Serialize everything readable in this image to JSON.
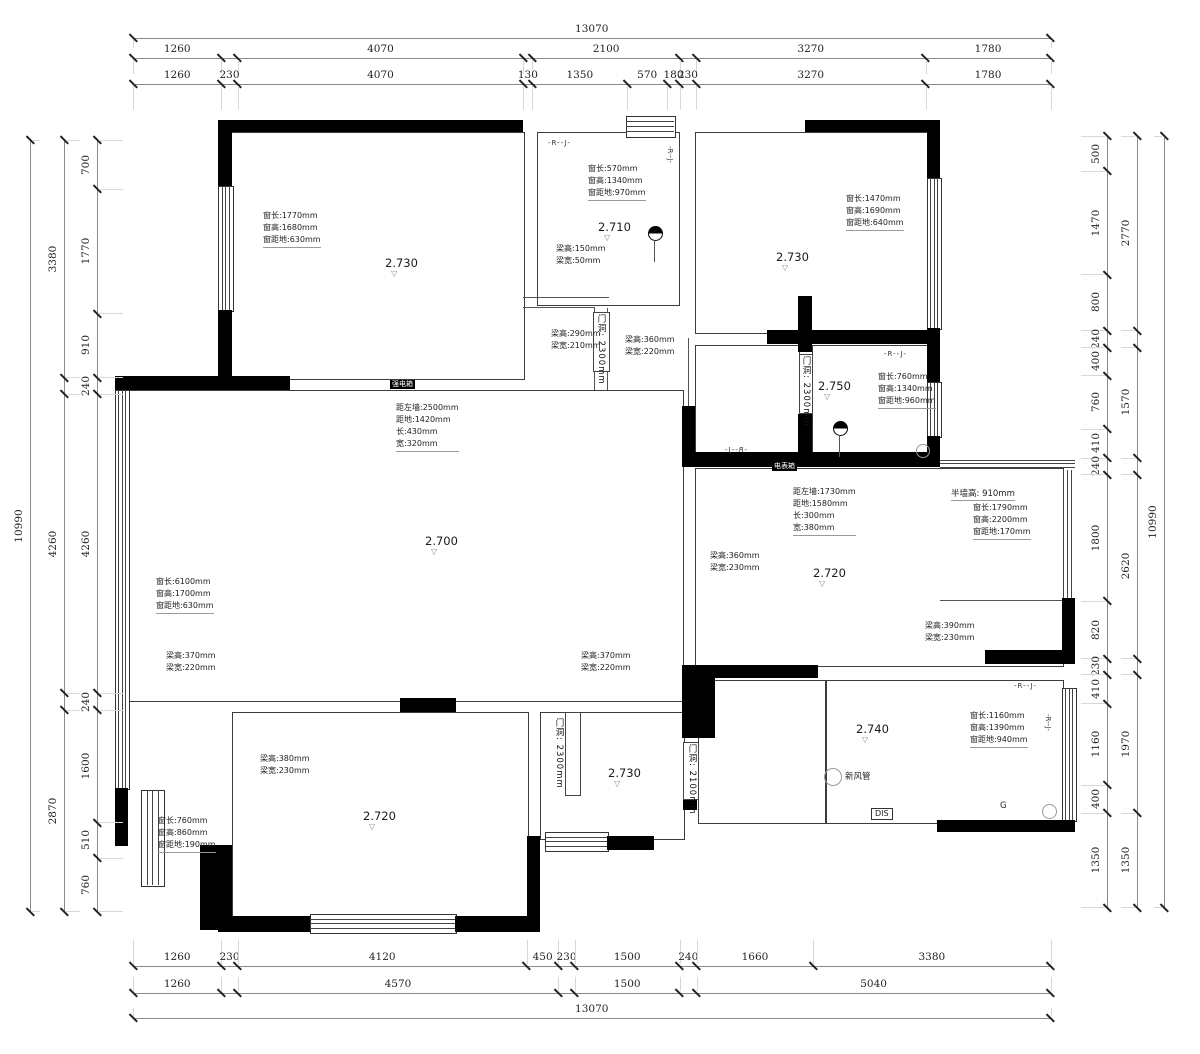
{
  "drawing": {
    "type": "floor-plan-structural-survey",
    "units": "mm",
    "wall_color": "#000000",
    "line_color": "#3c3c3c",
    "dim_text_color": "#222222"
  },
  "dims": {
    "scale": 0.0702,
    "rows": [
      {
        "id": "top-total",
        "dir": "h",
        "x": 133,
        "y": 38,
        "segments": [
          {
            "mm": 13070,
            "label": "13070"
          }
        ]
      },
      {
        "id": "top-major",
        "dir": "h",
        "x": 133,
        "y": 58,
        "segments": [
          {
            "mm": 1260,
            "label": "1260"
          },
          {
            "mm": 230,
            "label": ""
          },
          {
            "mm": 4070,
            "label": "4070"
          },
          {
            "mm": 130,
            "label": ""
          },
          {
            "mm": 2100,
            "label": "2100"
          },
          {
            "mm": 230,
            "label": ""
          },
          {
            "mm": 3270,
            "label": "3270"
          },
          {
            "mm": 1780,
            "label": "1780"
          }
        ]
      },
      {
        "id": "top-detail",
        "dir": "h",
        "x": 133,
        "y": 84,
        "segments": [
          {
            "mm": 1260,
            "label": "1260"
          },
          {
            "mm": 230,
            "label": "230"
          },
          {
            "mm": 4070,
            "label": "4070"
          },
          {
            "mm": 130,
            "label": "130"
          },
          {
            "mm": 1350,
            "label": "1350"
          },
          {
            "mm": 570,
            "label": "570"
          },
          {
            "mm": 180,
            "label": "180"
          },
          {
            "mm": 230,
            "label": "230"
          },
          {
            "mm": 3270,
            "label": "3270"
          },
          {
            "mm": 1780,
            "label": "1780"
          }
        ]
      },
      {
        "id": "bottom-detail",
        "dir": "h",
        "x": 133,
        "y": 966,
        "segments": [
          {
            "mm": 1260,
            "label": "1260"
          },
          {
            "mm": 230,
            "label": "230"
          },
          {
            "mm": 4120,
            "label": "4120"
          },
          {
            "mm": 450,
            "label": "450"
          },
          {
            "mm": 230,
            "label": "230"
          },
          {
            "mm": 1500,
            "label": "1500"
          },
          {
            "mm": 240,
            "label": "240"
          },
          {
            "mm": 1660,
            "label": "1660"
          },
          {
            "mm": 3380,
            "label": "3380"
          }
        ]
      },
      {
        "id": "bottom-major",
        "dir": "h",
        "x": 133,
        "y": 993,
        "segments": [
          {
            "mm": 1260,
            "label": "1260"
          },
          {
            "mm": 230,
            "label": ""
          },
          {
            "mm": 4570,
            "label": "4570"
          },
          {
            "mm": 230,
            "label": ""
          },
          {
            "mm": 1500,
            "label": "1500"
          },
          {
            "mm": 240,
            "label": ""
          },
          {
            "mm": 5040,
            "label": "5040"
          }
        ]
      },
      {
        "id": "bottom-total",
        "dir": "h",
        "x": 133,
        "y": 1018,
        "segments": [
          {
            "mm": 13070,
            "label": "13070"
          }
        ]
      },
      {
        "id": "left-detail",
        "dir": "v",
        "x": 97,
        "y": 140,
        "segments": [
          {
            "mm": 700,
            "label": "700"
          },
          {
            "mm": 1770,
            "label": "1770"
          },
          {
            "mm": 910,
            "label": "910"
          },
          {
            "mm": 240,
            "label": "240"
          },
          {
            "mm": 4260,
            "label": "4260"
          },
          {
            "mm": 240,
            "label": "240"
          },
          {
            "mm": 1600,
            "label": "1600"
          },
          {
            "mm": 510,
            "label": "510"
          },
          {
            "mm": 760,
            "label": "760"
          }
        ]
      },
      {
        "id": "left-major",
        "dir": "v",
        "x": 64,
        "y": 140,
        "segments": [
          {
            "mm": 3380,
            "label": "3380"
          },
          {
            "mm": 240,
            "label": ""
          },
          {
            "mm": 4260,
            "label": "4260"
          },
          {
            "mm": 240,
            "label": ""
          },
          {
            "mm": 2870,
            "label": "2870"
          }
        ]
      },
      {
        "id": "left-total",
        "dir": "v",
        "x": 30,
        "y": 140,
        "segments": [
          {
            "mm": 10990,
            "label": "10990"
          }
        ]
      },
      {
        "id": "right-detail",
        "dir": "v",
        "x": 1107,
        "y": 136,
        "segments": [
          {
            "mm": 500,
            "label": "500"
          },
          {
            "mm": 1470,
            "label": "1470"
          },
          {
            "mm": 800,
            "label": "800"
          },
          {
            "mm": 240,
            "label": "240"
          },
          {
            "mm": 400,
            "label": "400"
          },
          {
            "mm": 760,
            "label": "760"
          },
          {
            "mm": 410,
            "label": "410"
          },
          {
            "mm": 240,
            "label": "240"
          },
          {
            "mm": 1800,
            "label": "1800"
          },
          {
            "mm": 820,
            "label": "820"
          },
          {
            "mm": 230,
            "label": "230"
          },
          {
            "mm": 410,
            "label": "410"
          },
          {
            "mm": 1160,
            "label": "1160"
          },
          {
            "mm": 400,
            "label": "400"
          },
          {
            "mm": 1350,
            "label": "1350"
          }
        ]
      },
      {
        "id": "right-major",
        "dir": "v",
        "x": 1137,
        "y": 136,
        "segments": [
          {
            "mm": 2770,
            "label": "2770"
          },
          {
            "mm": 240,
            "label": ""
          },
          {
            "mm": 1570,
            "label": "1570"
          },
          {
            "mm": 240,
            "label": ""
          },
          {
            "mm": 2620,
            "label": "2620"
          },
          {
            "mm": 230,
            "label": ""
          },
          {
            "mm": 1970,
            "label": "1970"
          },
          {
            "mm": 1350,
            "label": "1350"
          }
        ]
      },
      {
        "id": "right-total",
        "dir": "v",
        "x": 1164,
        "y": 136,
        "segments": [
          {
            "mm": 10990,
            "label": "10990"
          }
        ]
      }
    ]
  },
  "annotations": [
    {
      "type": "win3",
      "x": 263,
      "y": 210,
      "lines": [
        "窗长:1770mm",
        "窗高:1680mm",
        "窗距地:630mm"
      ]
    },
    {
      "type": "room",
      "x": 385,
      "y": 256,
      "label": "2.730"
    },
    {
      "type": "rj",
      "x": 548,
      "y": 139,
      "text": "-R--J-"
    },
    {
      "type": "win3",
      "x": 588,
      "y": 163,
      "lines": [
        "窗长:570mm",
        "窗高:1340mm",
        "窗距地:970mm"
      ]
    },
    {
      "type": "rj-v",
      "x": 666,
      "y": 146,
      "text": "-R--J-"
    },
    {
      "type": "room",
      "x": 598,
      "y": 220,
      "label": "2.710"
    },
    {
      "type": "beam2",
      "x": 556,
      "y": 243,
      "lines": [
        "梁高:150mm",
        "梁宽:50mm"
      ]
    },
    {
      "type": "lamp",
      "x": 648,
      "y": 226
    },
    {
      "type": "win3",
      "x": 846,
      "y": 193,
      "lines": [
        "窗长:1470mm",
        "窗高:1690mm",
        "窗距地:640mm"
      ]
    },
    {
      "type": "room",
      "x": 776,
      "y": 250,
      "label": "2.730"
    },
    {
      "type": "beam2",
      "x": 551,
      "y": 328,
      "lines": [
        "梁高:290mm",
        "梁宽:210mm"
      ]
    },
    {
      "type": "vtext",
      "x": 595,
      "y": 314,
      "text": "门洞: 2300mm"
    },
    {
      "type": "beam2",
      "x": 625,
      "y": 334,
      "lines": [
        "梁高:360mm",
        "梁宽:220mm"
      ]
    },
    {
      "type": "vtext",
      "x": 800,
      "y": 356,
      "text": "门洞: 2300mm"
    },
    {
      "type": "room",
      "x": 818,
      "y": 379,
      "label": "2.750"
    },
    {
      "type": "win3",
      "x": 878,
      "y": 371,
      "lines": [
        "窗长:760mm",
        "窗高:1340mm",
        "窗距地:960mm"
      ]
    },
    {
      "type": "rj",
      "x": 884,
      "y": 350,
      "text": "-R--J-"
    },
    {
      "type": "lamp",
      "x": 833,
      "y": 421
    },
    {
      "type": "circle",
      "x": 916,
      "y": 444,
      "d": 12
    },
    {
      "type": "rj-mir",
      "x": 724,
      "y": 446,
      "text": "-R--J-"
    },
    {
      "type": "boxlabel",
      "x": 772,
      "y": 462,
      "text": "电表箱"
    },
    {
      "type": "niche4",
      "x": 793,
      "y": 486,
      "lines": [
        "距左墙:1730mm",
        "距地:1580mm",
        "长:300mm",
        "宽:380mm"
      ]
    },
    {
      "type": "plainline",
      "x": 951,
      "y": 487,
      "text": "半墙高: 910mm"
    },
    {
      "type": "win3",
      "x": 973,
      "y": 502,
      "lines": [
        "窗长:1790mm",
        "窗高:2200mm",
        "窗距地:170mm"
      ]
    },
    {
      "type": "niche4",
      "x": 396,
      "y": 402,
      "lines": [
        "距左墙:2500mm",
        "距地:1420mm",
        "长:430mm",
        "宽:320mm"
      ]
    },
    {
      "type": "room",
      "x": 425,
      "y": 534,
      "label": "2.700"
    },
    {
      "type": "beam2",
      "x": 710,
      "y": 550,
      "lines": [
        "梁高:360mm",
        "梁宽:230mm"
      ]
    },
    {
      "type": "room",
      "x": 813,
      "y": 566,
      "label": "2.720"
    },
    {
      "type": "win3",
      "x": 156,
      "y": 576,
      "lines": [
        "窗长:6100mm",
        "窗高:1700mm",
        "窗距地:630mm"
      ]
    },
    {
      "type": "beam2",
      "x": 925,
      "y": 620,
      "lines": [
        "梁高:390mm",
        "梁宽:230mm"
      ]
    },
    {
      "type": "beam2",
      "x": 166,
      "y": 650,
      "lines": [
        "梁高:370mm",
        "梁宽:220mm"
      ]
    },
    {
      "type": "beam2",
      "x": 581,
      "y": 650,
      "lines": [
        "梁高:370mm",
        "梁宽:220mm"
      ]
    },
    {
      "type": "rj",
      "x": 1014,
      "y": 682,
      "text": "-R--J-"
    },
    {
      "type": "vtext",
      "x": 553,
      "y": 718,
      "text": "门洞: 2300mm"
    },
    {
      "type": "room",
      "x": 856,
      "y": 722,
      "label": "2.740"
    },
    {
      "type": "win3",
      "x": 970,
      "y": 710,
      "lines": [
        "窗长:1160mm",
        "窗高:1390mm",
        "窗距地:940mm"
      ]
    },
    {
      "type": "rj-v",
      "x": 1044,
      "y": 714,
      "text": "-R--J-"
    },
    {
      "type": "beam2",
      "x": 260,
      "y": 753,
      "lines": [
        "梁高:380mm",
        "梁宽:230mm"
      ]
    },
    {
      "type": "room",
      "x": 608,
      "y": 766,
      "label": "2.730"
    },
    {
      "type": "vtext",
      "x": 686,
      "y": 744,
      "text": "门洞: 2100mm"
    },
    {
      "type": "circle",
      "x": 824,
      "y": 768,
      "d": 16
    },
    {
      "type": "plain",
      "x": 845,
      "y": 770,
      "text": "新风管"
    },
    {
      "type": "win3",
      "x": 158,
      "y": 815,
      "lines": [
        "窗长:760mm",
        "窗高:860mm",
        "窗距地:190mm"
      ]
    },
    {
      "type": "room",
      "x": 363,
      "y": 809,
      "label": "2.720"
    },
    {
      "type": "disbox",
      "x": 871,
      "y": 808,
      "text": "DIS"
    },
    {
      "type": "plain",
      "x": 1000,
      "y": 801,
      "text": "G"
    },
    {
      "type": "circle",
      "x": 1042,
      "y": 804,
      "d": 13
    },
    {
      "type": "boxlabel",
      "x": 390,
      "y": 380,
      "text": "强电箱"
    }
  ]
}
